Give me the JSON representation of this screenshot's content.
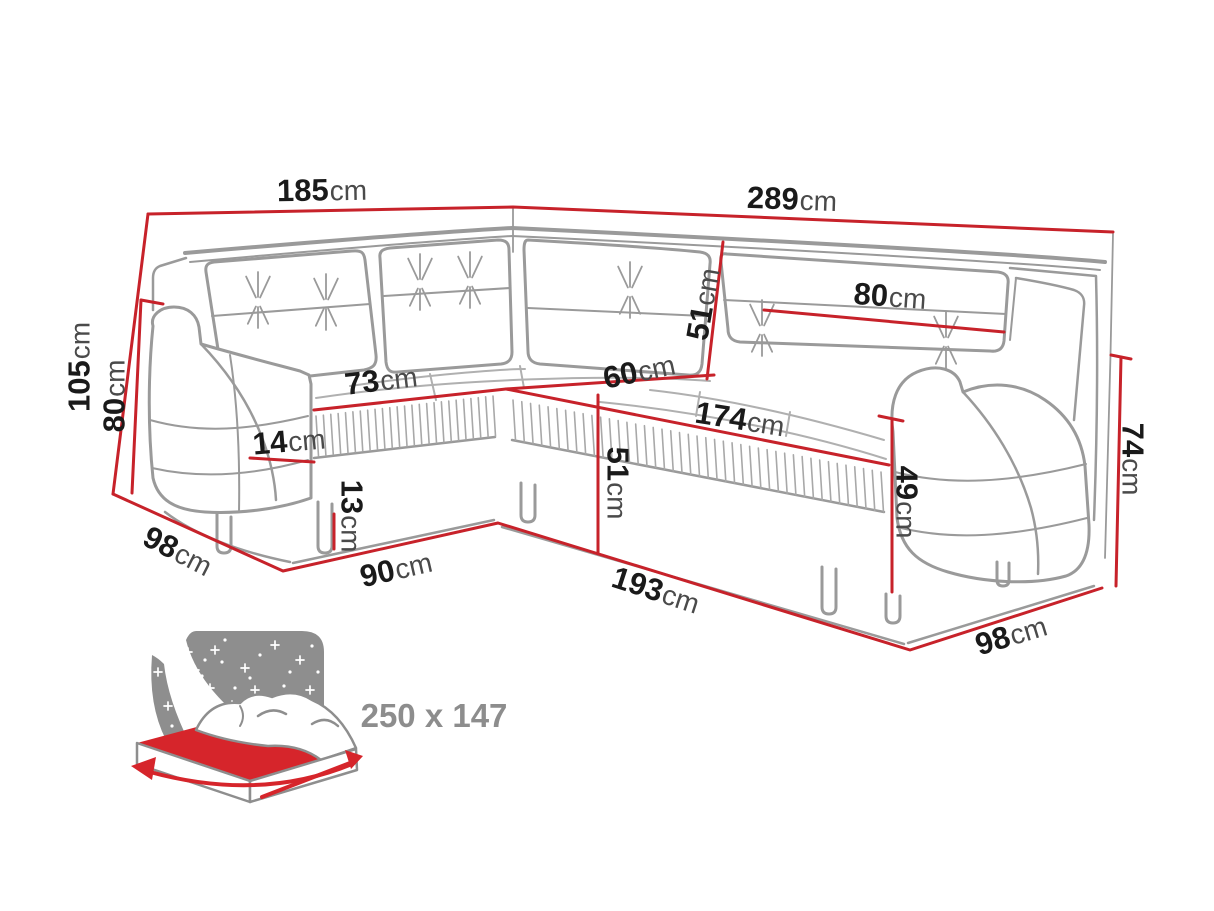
{
  "diagram": {
    "type": "corner-sofa-dimension-diagram",
    "colors": {
      "dimension_line": "#c7222a",
      "sofa_outline": "#9a9a9a",
      "label_number": "#1a1a1a",
      "label_unit": "#4a4a4a",
      "sleeping_label": "#8d8d8d",
      "bed_accent": "#d6252b",
      "night_panel": "#8e8e8e"
    },
    "dimensions": [
      {
        "id": "total-width-left",
        "value": "185",
        "unit": "cm"
      },
      {
        "id": "total-width-right",
        "value": "289",
        "unit": "cm"
      },
      {
        "id": "total-height",
        "value": "105",
        "unit": "cm"
      },
      {
        "id": "backrest-height",
        "value": "80",
        "unit": "cm"
      },
      {
        "id": "depth-left",
        "value": "98",
        "unit": "cm"
      },
      {
        "id": "seat-width-left",
        "value": "73",
        "unit": "cm"
      },
      {
        "id": "armrest-width",
        "value": "14",
        "unit": "cm"
      },
      {
        "id": "leg-height",
        "value": "13",
        "unit": "cm"
      },
      {
        "id": "base-width-left",
        "value": "90",
        "unit": "cm"
      },
      {
        "id": "corner-back-height",
        "value": "51",
        "unit": "cm"
      },
      {
        "id": "corner-seat-depth",
        "value": "60",
        "unit": "cm"
      },
      {
        "id": "seat-width-right",
        "value": "174",
        "unit": "cm"
      },
      {
        "id": "seat-height",
        "value": "51",
        "unit": "cm"
      },
      {
        "id": "base-width-right",
        "value": "193",
        "unit": "cm"
      },
      {
        "id": "back-cushion-width",
        "value": "80",
        "unit": "cm"
      },
      {
        "id": "armrest-height",
        "value": "49",
        "unit": "cm"
      },
      {
        "id": "arm-side-height",
        "value": "74",
        "unit": "cm"
      },
      {
        "id": "depth-right",
        "value": "98",
        "unit": "cm"
      }
    ],
    "sleeping_area": {
      "label": "250 x 147",
      "icon": "bed-sleeping-function-icon"
    }
  }
}
